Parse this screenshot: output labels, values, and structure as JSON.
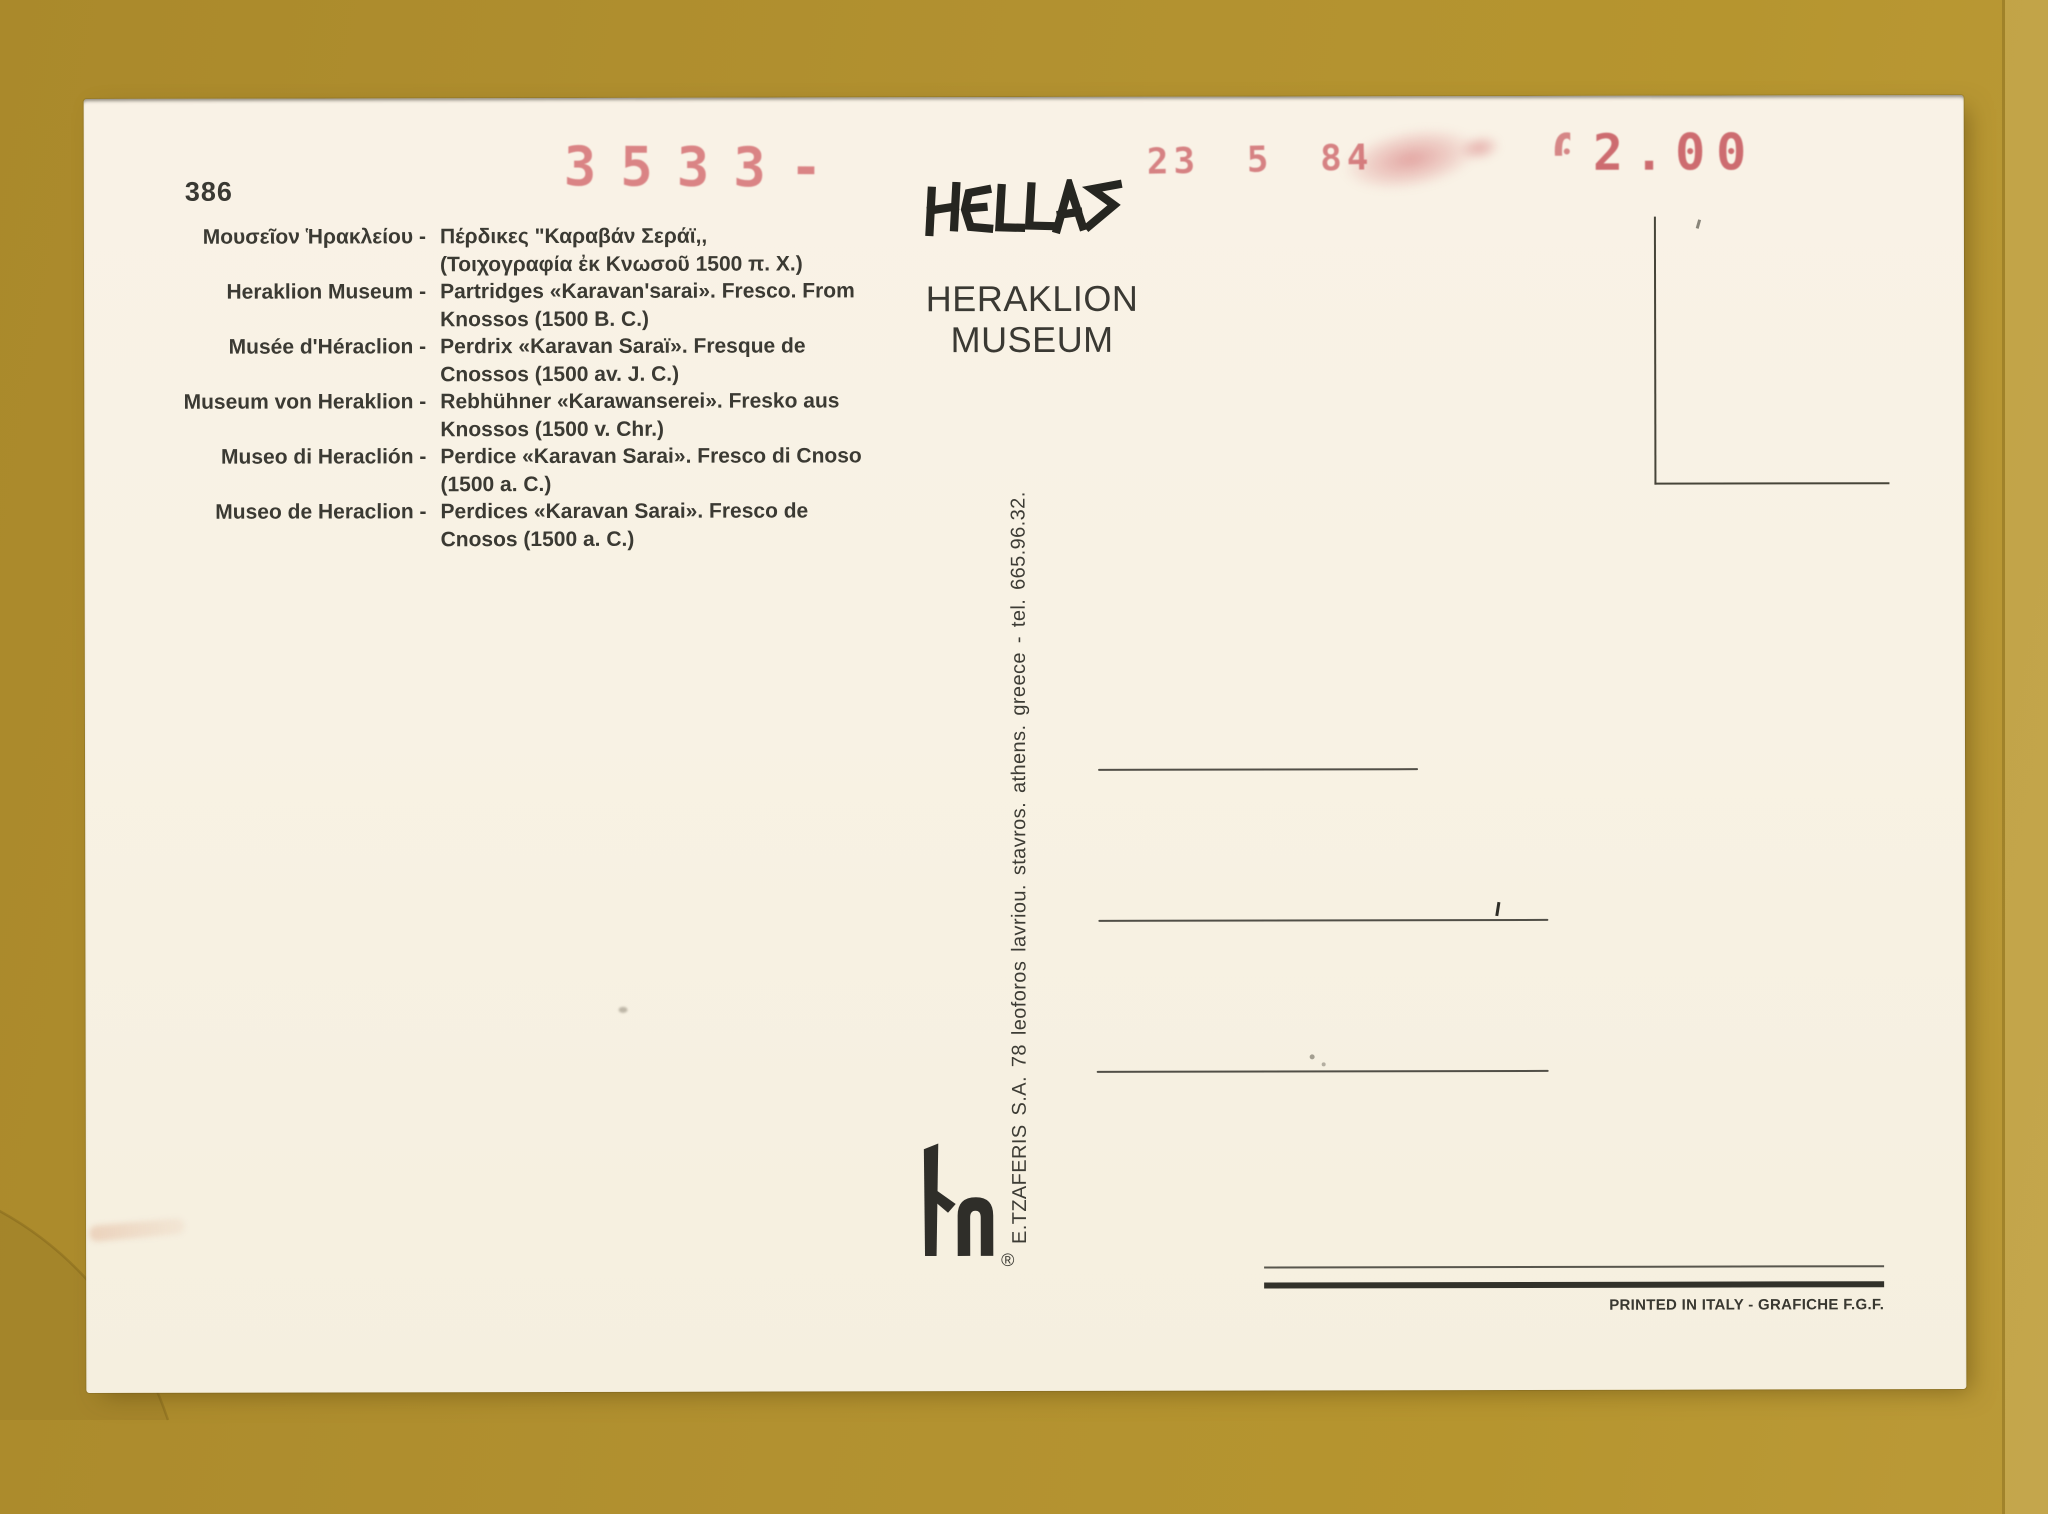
{
  "postcard": {
    "number": "386",
    "captions": [
      {
        "label": "Μουσεῖον Ἡρακλείου -",
        "desc": "Πέρδικες \"Καραβάν Σεράϊ,,\n(Τοιχογραφία ἐκ Κνωσοῦ 1500 π. Χ.)"
      },
      {
        "label": "Heraklion Museum -",
        "desc": "Partridges «Karavan'sarai». Fresco. From\nKnossos (1500 B. C.)"
      },
      {
        "label": "Musée d'Héraclion -",
        "desc": "Perdrix «Karavan Saraï». Fresque de\nCnossos (1500 av. J. C.)"
      },
      {
        "label": "Museum von Heraklion -",
        "desc": "Rebhühner «Karawanserei». Fresko aus\nKnossos (1500 v. Chr.)"
      },
      {
        "label": "Museo di Heraclión -",
        "desc": "Perdice «Karavan Sarai». Fresco di Cnoso\n(1500 a. C.)"
      },
      {
        "label": "Museo de Heraclion -",
        "desc": "Perdices «Karavan Sarai». Fresco de\nCnosos (1500 a. C.)"
      }
    ],
    "hellas_label": "HELLAS",
    "museum_line1": "HERAKLION",
    "museum_line2": "MUSEUM",
    "meter_number": "3533-",
    "date_stamp": "23 5 84",
    "meter_value_leading": "0",
    "meter_value_rest": "2.00",
    "publisher_line": "E.TZAFERIS S.A.  78 leoforos lavriou. stavros. athens. greece - tel. 665.96.32.",
    "registered_mark": "®",
    "print_credit": "PRINTED IN ITALY - GRAFICHE F.G.F.",
    "colors": {
      "background": "#b29130",
      "card": "#f8f2e4",
      "ink": "#3b3a33",
      "stamp_red": "#cf6a6e"
    }
  }
}
